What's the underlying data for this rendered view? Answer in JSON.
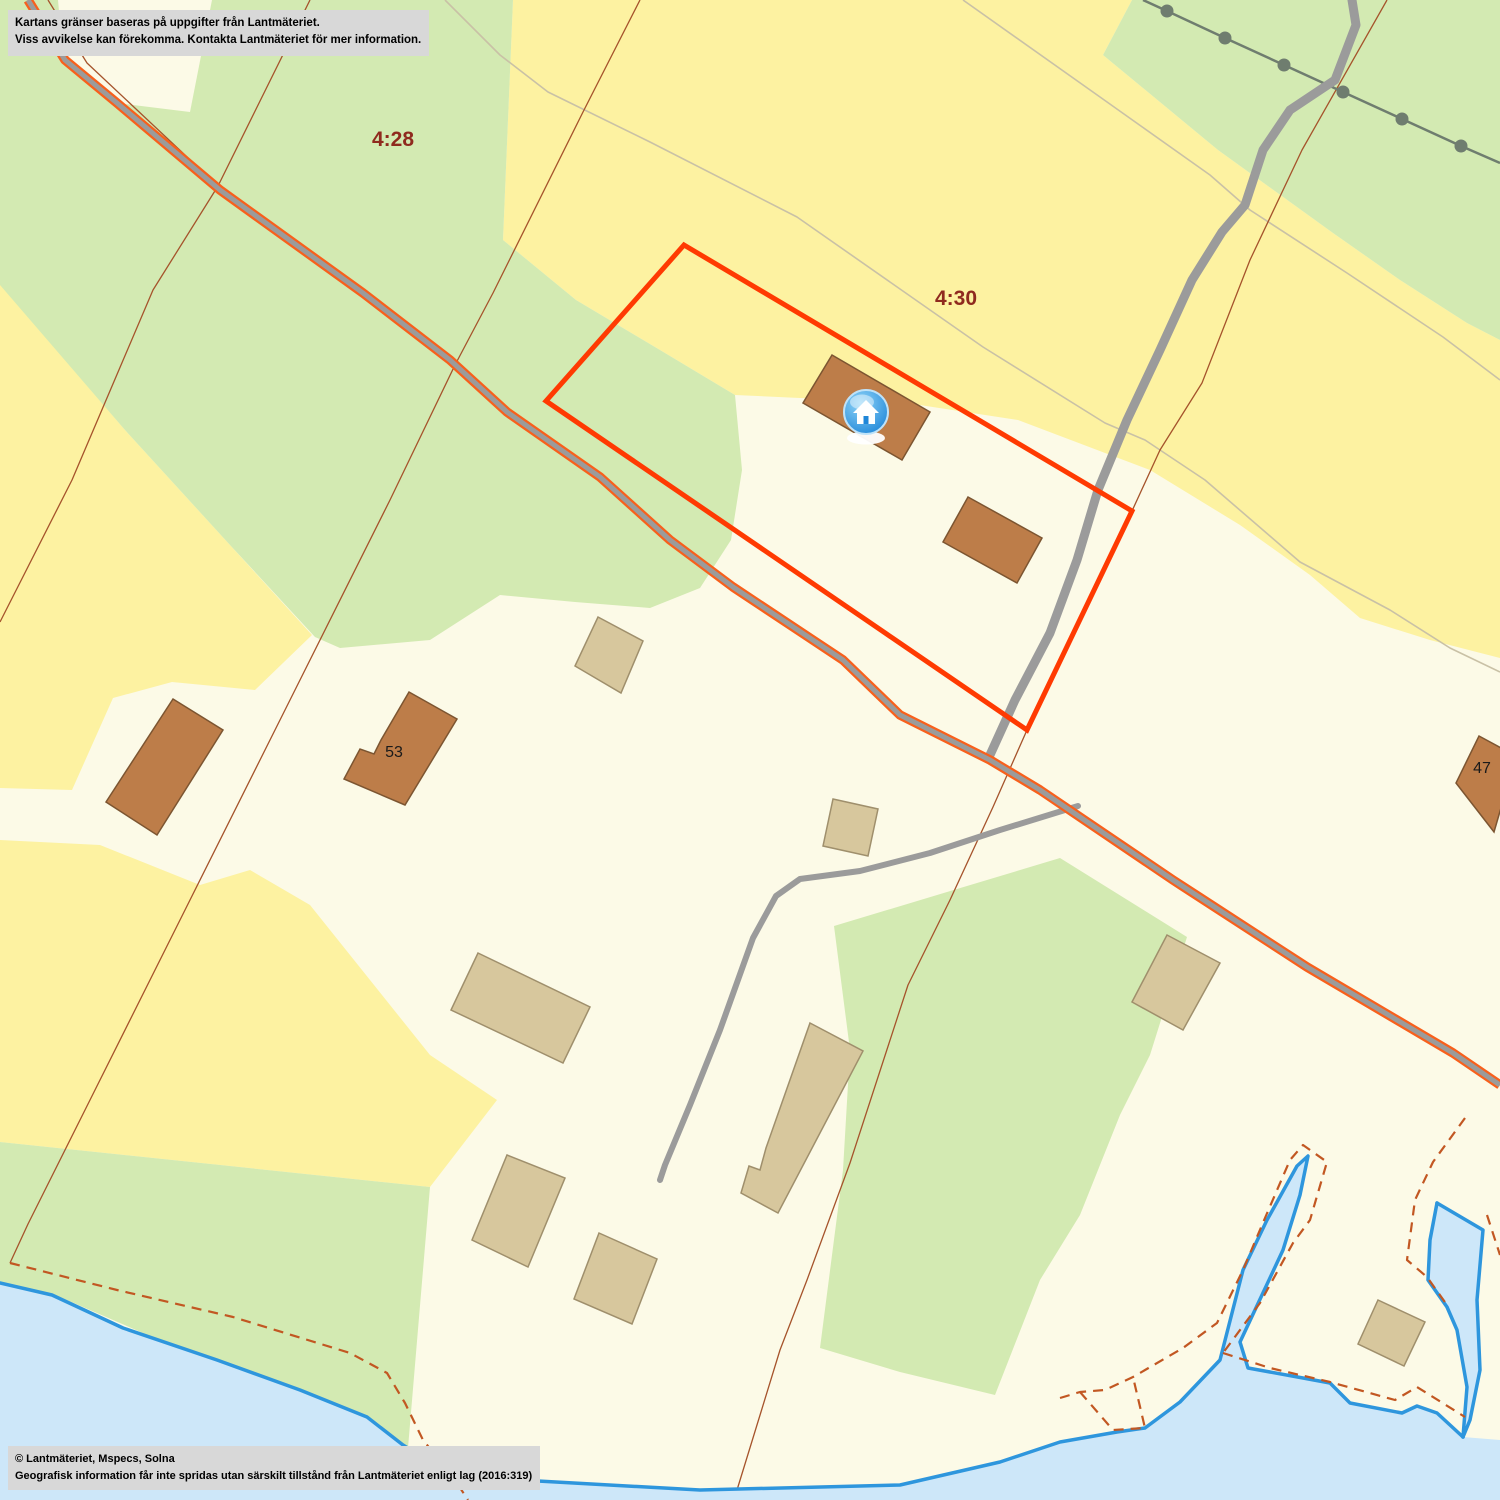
{
  "overlays": {
    "disclaimer": {
      "line1": "Kartans gränser baseras på uppgifter från Lantmäteriet.",
      "line2": "Viss avvikelse kan förekomma. Kontakta Lantmäteriet för mer information."
    },
    "copyright": {
      "line1": "© Lantmäteriet, Mspecs, Solna",
      "line2": "Geografisk information får inte spridas utan särskilt tillstånd från Lantmäteriet enligt lag (2016:319)"
    }
  },
  "map": {
    "width": 1500,
    "height": 1500,
    "palette": {
      "cream": "#fcfae7",
      "yellow": "#fdf2a1",
      "green": "#d3eab2",
      "water": "#cde7f9",
      "shore": "#2e96dd",
      "road_gray": "#9b9b9b",
      "road_orange": "#f8601c",
      "boundary": "#a5532b",
      "path": "#c9c1a6",
      "dashed": "#c25722",
      "selection": "#ff3a02",
      "brown_fill": "#bd7d49",
      "brown_stroke": "#7c5531",
      "tan_fill": "#d7c79d",
      "tan_stroke": "#9f8f6c",
      "label_red": "#8f2a1e",
      "label_black": "#1a1a1a",
      "powerline": "#6f7d6f",
      "note_bg": "#d8d8d8",
      "marker_blue_light": "#8fd4f8",
      "marker_blue_dark": "#1f86d8"
    },
    "parcel_labels": [
      {
        "text": "4:28",
        "x": 393,
        "y": 146
      },
      {
        "text": "4:30",
        "x": 956,
        "y": 305
      }
    ],
    "house_labels": [
      {
        "text": "53",
        "x": 394,
        "y": 757
      },
      {
        "text": "47",
        "x": 1482,
        "y": 773
      }
    ],
    "marker": {
      "x": 866,
      "y": 412
    },
    "layers": [
      {
        "name": "region-yellow-north",
        "type": "polygon",
        "fill": "yellow",
        "points": "513,0 1132,0 1103,55 1218,150 1333,233 1400,280 1467,323 1500,340 1500,658 1430,640 1360,618 1310,575 1240,525 1150,470 1018,420 900,402 800,398 735,395 660,350 576,300 503,240"
      },
      {
        "name": "region-yellow-west-upper",
        "type": "polygon",
        "fill": "yellow",
        "points": "0,283 125,430 230,545 312,635 255,690 172,682 113,698 72,790 0,788"
      },
      {
        "name": "region-yellow-west-lower",
        "type": "polygon",
        "fill": "yellow",
        "points": "0,840 100,845 200,885 250,870 310,905 430,1055 497,1100 430,1187 0,1142"
      },
      {
        "name": "region-green-northwest",
        "type": "polygon",
        "fill": "green",
        "points": "0,0 513,0 503,240 576,300 660,350 735,395 742,470 731,540 700,588 650,608 575,602 500,595 430,640 340,648 315,637 230,545 125,430 0,285"
      },
      {
        "name": "region-green-northeast",
        "type": "polygon",
        "fill": "green",
        "points": "1132,0 1500,0 1500,340 1467,323 1400,280 1333,233 1218,150 1103,55"
      },
      {
        "name": "region-green-southeast",
        "type": "polygon",
        "fill": "green",
        "points": "834,926 1060,858 1187,937 1150,1055 1120,1115 1080,1215 1040,1280 995,1395 900,1372 820,1348 843,1170 850,1050"
      },
      {
        "name": "region-green-coast",
        "type": "polygon",
        "fill": "green",
        "points": "0,1142 430,1187 408,1448 60,1297 0,1283"
      },
      {
        "name": "region-cream-wedge",
        "type": "polygon",
        "fill": "cream",
        "points": "58,0 212,0 190,112 117,103 63,57"
      },
      {
        "name": "path-track-south",
        "type": "polyline",
        "stroke": "path",
        "w": 1.6,
        "points": "445,0 500,55 548,92 650,142 797,217 983,347 1105,423 1145,440 1205,480 1300,562 1390,610 1450,648 1500,672"
      },
      {
        "name": "path-track-north",
        "type": "polyline",
        "stroke": "path",
        "w": 1.6,
        "points": "963,0 1100,97 1210,175 1250,210 1347,273 1443,337 1500,380"
      },
      {
        "name": "parcel-boundary-west",
        "type": "polyline",
        "stroke": "boundary",
        "w": 1.3,
        "points": "640,0 583,112 493,293 455,365 390,500 290,700 190,900 90,1100 28,1224 10,1263"
      },
      {
        "name": "parcel-boundary-northwest",
        "type": "polyline",
        "stroke": "boundary",
        "w": 1.3,
        "points": "310,0 218,186 153,290 72,480 0,622"
      },
      {
        "name": "parcel-boundary-roadside",
        "type": "polyline",
        "stroke": "boundary",
        "w": 1.3,
        "points": "48,0 87,63 218,186"
      },
      {
        "name": "parcel-boundary-east",
        "type": "polyline",
        "stroke": "boundary",
        "w": 1.3,
        "points": "1387,0 1302,150 1250,260 1202,383 1160,450 1132,511 1060,660 1027,730 993,807 950,900 908,985 850,1163 807,1280 780,1350 737,1490"
      },
      {
        "name": "powerline",
        "type": "powerline",
        "stroke": "powerline",
        "w": 2.5,
        "r": 6.5,
        "points": "1143,0 1167,11 1225,38 1284,65 1343,92 1402,119 1461,146 1500,163"
      },
      {
        "name": "road-north",
        "type": "polyline",
        "stroke": "road_gray",
        "w": 9,
        "cap": "round",
        "points": "1352,0 1356,25 1335,80 1290,110 1263,150 1245,205 1222,232 1192,280 1160,350 1127,420 1098,490 1077,560 1050,633 1015,700 990,755"
      },
      {
        "name": "road-side-spur",
        "type": "polyline",
        "stroke": "road_gray",
        "w": 6,
        "cap": "round",
        "points": "1078,806 1000,830 930,853 860,871 800,879 776,896 753,938 720,1030 690,1105 665,1165 660,1180"
      },
      {
        "name": "road-main-edge",
        "type": "polyline",
        "stroke": "road_orange",
        "w": 9.5,
        "cap": "butt",
        "points": "28,0 65,60 117,103 220,190 363,293 450,360 507,412 600,477 670,540 733,587 843,660 900,715 990,760 1040,790 1173,880 1307,967 1453,1053 1500,1085"
      },
      {
        "name": "road-main",
        "type": "polyline",
        "stroke": "road_gray",
        "w": 5,
        "cap": "butt",
        "points": "28,0 65,60 117,103 220,190 363,293 450,360 507,412 600,477 670,540 733,587 843,660 900,715 990,760 1040,790 1173,880 1307,967 1453,1053 1500,1085"
      },
      {
        "name": "selected-parcel-outline",
        "type": "polygon",
        "fill": "none",
        "stroke": "selection",
        "w": 5,
        "points": "684,245 1132,511 1027,730 546,401"
      },
      {
        "name": "water-sea",
        "type": "polygon",
        "fill": "water",
        "points": "0,1283 52,1295 123,1328 217,1360 300,1390 367,1417 403,1445 445,1472 520,1480 700,1490 900,1485 1000,1462 1060,1442 1117,1432 1145,1428 1180,1402 1220,1360 1243,1270 1267,1220 1297,1166 1308,1156 1300,1195 1283,1250 1262,1295 1240,1342 1248,1368 1303,1378 1330,1383 1350,1403 1402,1413 1417,1406 1437,1413 1463,1437 1500,1440 1500,1500 0,1500"
      },
      {
        "name": "shoreline",
        "type": "polyline",
        "stroke": "shore",
        "w": 3.5,
        "cap": "round",
        "points": "0,1283 52,1295 123,1328 217,1360 300,1390 367,1417 403,1445 445,1472 520,1480 700,1490 900,1485 1000,1462 1060,1442 1117,1432 1145,1428 1180,1402 1220,1360 1243,1270 1267,1220 1297,1166 1308,1156 1300,1195 1283,1250 1262,1295 1240,1342 1248,1368 1303,1378 1330,1383 1350,1403 1402,1413 1417,1406 1437,1413 1463,1437"
      },
      {
        "name": "water-bay",
        "type": "polygon",
        "fill": "water",
        "points": "1437,1203 1483,1230 1477,1300 1480,1370 1470,1420 1463,1437 1467,1387 1457,1330 1447,1307 1428,1280 1430,1240"
      },
      {
        "name": "bay-shore-west",
        "type": "polyline",
        "stroke": "shore",
        "w": 3.5,
        "cap": "round",
        "points": "1437,1203 1430,1240 1428,1280 1447,1307 1457,1330 1467,1387 1463,1437"
      },
      {
        "name": "bay-shore-east",
        "type": "polyline",
        "stroke": "shore",
        "w": 3.5,
        "cap": "round",
        "points": "1437,1203 1483,1230 1477,1300 1480,1370 1470,1420 1463,1437"
      },
      {
        "name": "dashed-boundary-coast",
        "type": "polyline",
        "stroke": "dashed",
        "w": 2.2,
        "dash": "10 7",
        "points": "10,1263 117,1290 233,1317 350,1353 387,1373 405,1403 423,1440 453,1477 468,1500"
      },
      {
        "name": "dashed-boundary-inlet",
        "type": "polyline",
        "stroke": "dashed",
        "w": 2.2,
        "dash": "10 7",
        "points": "1060,1398 1080,1392 1105,1390 1133,1377 1183,1348 1217,1323 1243,1270 1265,1218 1290,1160 1303,1145 1327,1162 1310,1220 1293,1243 1260,1303 1223,1353"
      },
      {
        "name": "dashed-boundary-notch",
        "type": "polyline",
        "stroke": "dashed",
        "w": 2.2,
        "dash": "10 7",
        "points": "1080,1392 1113,1430 1145,1428 1133,1377"
      },
      {
        "name": "dashed-boundary-shore-east",
        "type": "polyline",
        "stroke": "dashed",
        "w": 2.2,
        "dash": "10 7",
        "points": "1223,1353 1270,1368 1330,1382 1395,1400 1417,1387 1465,1417"
      },
      {
        "name": "dashed-boundary-bay",
        "type": "polyline",
        "stroke": "dashed",
        "w": 2.2,
        "dash": "10 7",
        "points": "1465,1118 1433,1162 1415,1200 1407,1260 1427,1277 1447,1305"
      },
      {
        "name": "dashed-boundary-right-edge",
        "type": "polyline",
        "stroke": "dashed",
        "w": 2.2,
        "dash": "10 7",
        "points": "1487,1215 1500,1255"
      },
      {
        "name": "building-residential-marker-house",
        "type": "polygon",
        "fill": "brown_fill",
        "stroke": "brown_stroke",
        "w": 1.5,
        "points": "832,355 930,412 902,460 803,403"
      },
      {
        "name": "building-residential-2",
        "type": "polygon",
        "fill": "brown_fill",
        "stroke": "brown_stroke",
        "w": 1.5,
        "points": "968,497 1042,538 1017,583 943,542"
      },
      {
        "name": "building-residential-west",
        "type": "polygon",
        "fill": "brown_fill",
        "stroke": "brown_stroke",
        "w": 1.5,
        "points": "173,699 223,730 157,835 106,802"
      },
      {
        "name": "building-residential-53",
        "type": "polygon",
        "fill": "brown_fill",
        "stroke": "brown_stroke",
        "w": 1.5,
        "points": "409,692 457,719 405,805 344,779 360,749 374,754 381,740"
      },
      {
        "name": "building-residential-47",
        "type": "polygon",
        "fill": "brown_fill",
        "stroke": "brown_stroke",
        "w": 1.5,
        "points": "1479,736 1516,756 1494,832 1456,783"
      },
      {
        "name": "building-outbuilding-1",
        "type": "polygon",
        "fill": "tan_fill",
        "stroke": "tan_stroke",
        "w": 1.5,
        "points": "598,617 643,641 621,693 575,666"
      },
      {
        "name": "building-outbuilding-2",
        "type": "polygon",
        "fill": "tan_fill",
        "stroke": "tan_stroke",
        "w": 1.5,
        "points": "478,953 590,1007 563,1063 451,1010"
      },
      {
        "name": "building-outbuilding-3",
        "type": "polygon",
        "fill": "tan_fill",
        "stroke": "tan_stroke",
        "w": 1.5,
        "points": "507,1155 565,1178 528,1267 472,1240"
      },
      {
        "name": "building-outbuilding-4",
        "type": "polygon",
        "fill": "tan_fill",
        "stroke": "tan_stroke",
        "w": 1.5,
        "points": "599,1233 657,1259 632,1324 574,1299"
      },
      {
        "name": "building-outbuilding-5",
        "type": "polygon",
        "fill": "tan_fill",
        "stroke": "tan_stroke",
        "w": 1.5,
        "points": "810,1023 863,1051 778,1213 741,1193 749,1166 760,1170 766,1148"
      },
      {
        "name": "building-outbuilding-6",
        "type": "polygon",
        "fill": "tan_fill",
        "stroke": "tan_stroke",
        "w": 1.5,
        "points": "1167,935 1220,963 1183,1030 1132,1002"
      },
      {
        "name": "building-outbuilding-7",
        "type": "polygon",
        "fill": "tan_fill",
        "stroke": "tan_stroke",
        "w": 1.5,
        "points": "833,799 878,809 868,856 823,846"
      },
      {
        "name": "building-outbuilding-harbor",
        "type": "polygon",
        "fill": "tan_fill",
        "stroke": "tan_stroke",
        "w": 1.5,
        "points": "1378,1300 1425,1322 1404,1366 1358,1344"
      }
    ]
  }
}
